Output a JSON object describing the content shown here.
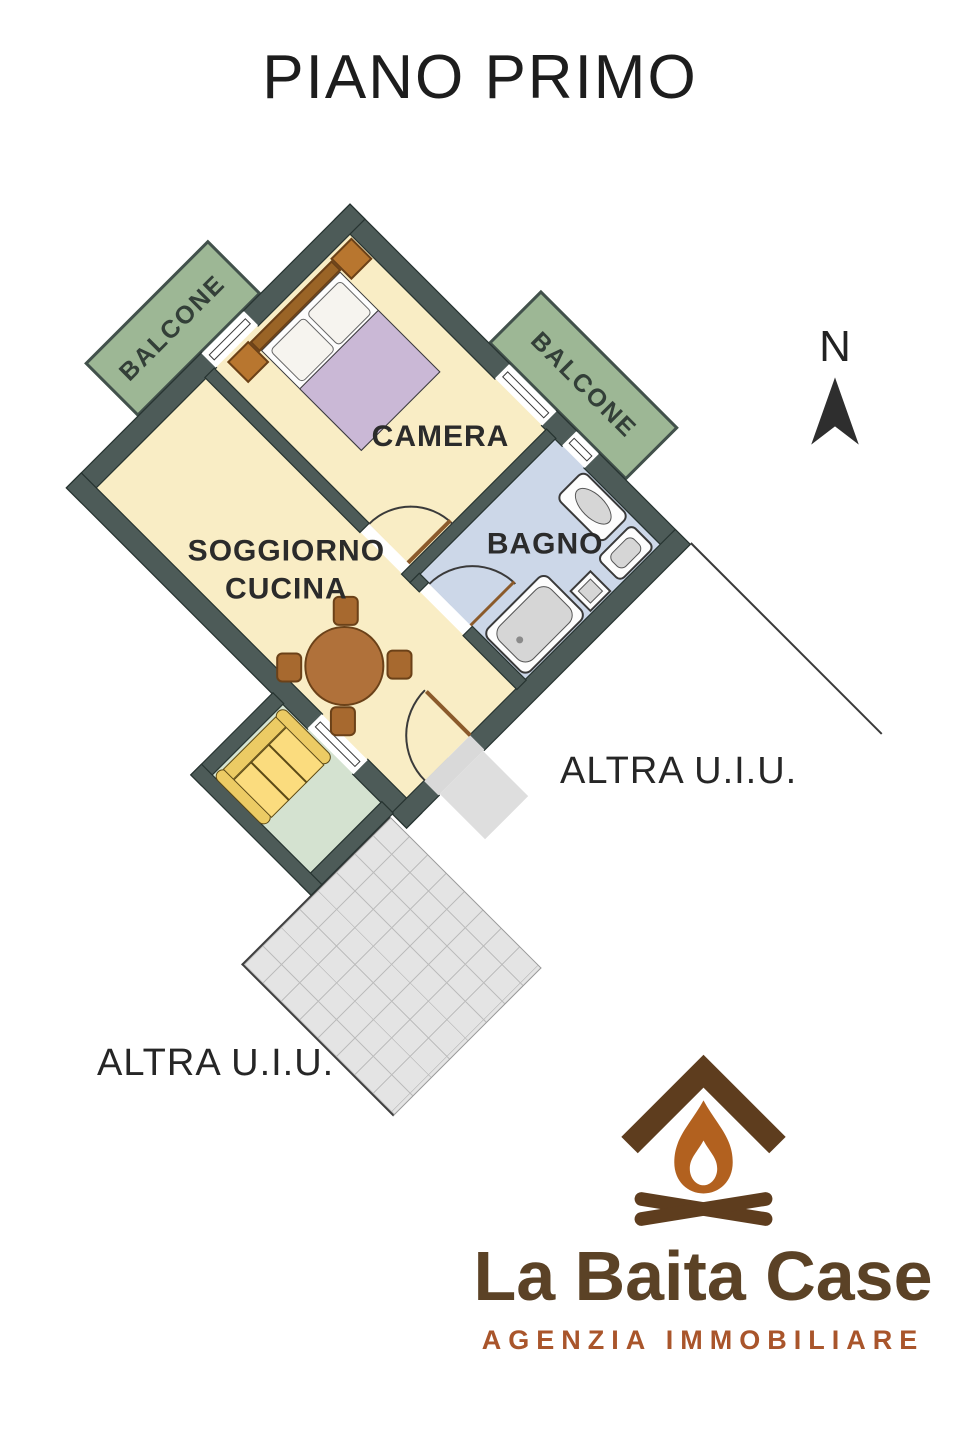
{
  "title": "PIANO PRIMO",
  "rooms": {
    "camera": "CAMERA",
    "bagno": "BAGNO",
    "soggiorno_line1": "SOGGIORNO",
    "soggiorno_line2": "CUCINA"
  },
  "balconies": {
    "left": "BALCONE",
    "top": "BALCONE"
  },
  "other_units": {
    "right": "ALTRA U.I.U.",
    "bottom": "ALTRA U.I.U."
  },
  "compass": {
    "north": "N"
  },
  "logo": {
    "name": "La Baita Case",
    "tagline": "AGENZIA IMMOBILIARE"
  },
  "colors": {
    "wall": "#4d5b58",
    "floor": "#f9edc5",
    "bath-floor": "#ccd7e8",
    "balcony": "#9db795",
    "veranda-floor": "#d4e2d0",
    "terrace": "#e4e4e4",
    "blanket": "#cab8d6",
    "wood": "#b0713a",
    "sofa": "#fbdc7e",
    "logo-brown": "#5b4226",
    "logo-orange": "#a9552b",
    "flame": "#b2611f",
    "ink": "#2b2b2b"
  }
}
